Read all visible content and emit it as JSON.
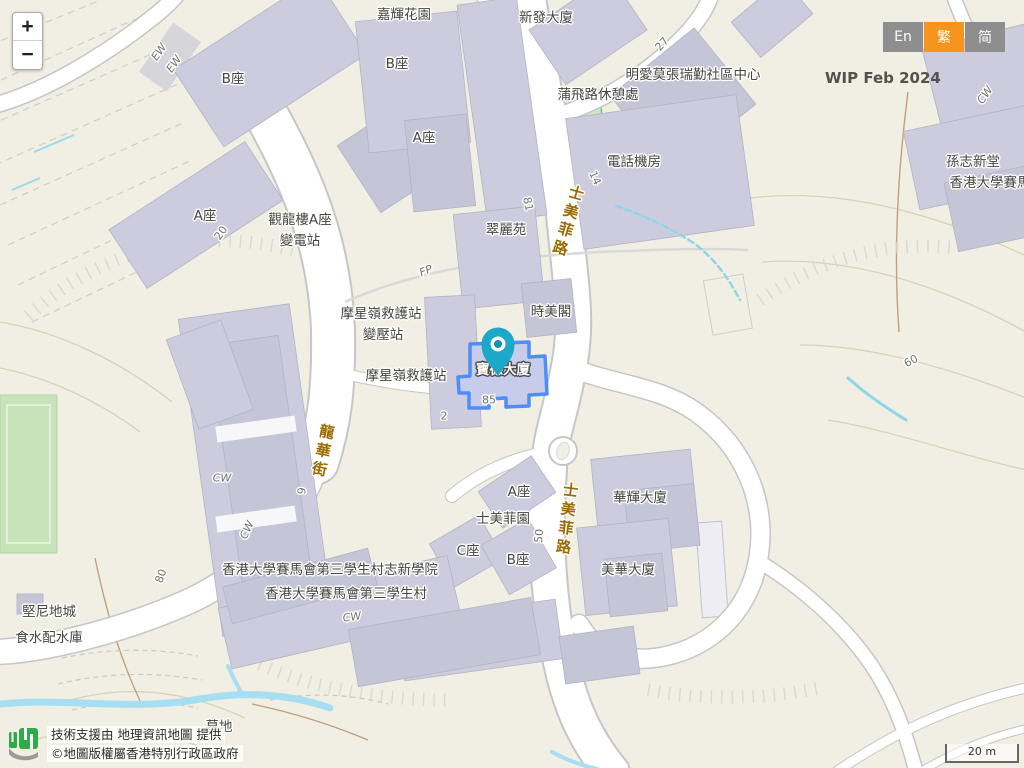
{
  "zoom_control": {
    "zoom_in": "+",
    "zoom_out": "−"
  },
  "language_switcher": {
    "options": [
      {
        "label": "En",
        "active": false
      },
      {
        "label": "繁",
        "active": true
      },
      {
        "label": "简",
        "active": false
      }
    ],
    "active_color": "#f7941d",
    "inactive_color": "#8e8e8e"
  },
  "watermark": "WIP Feb 2024",
  "attribution": {
    "line1": "技術支援由 地理資訊地圖 提供",
    "line2": "©地圖版權屬香港特別行政區政府",
    "logo": "geoinfo-map-logo"
  },
  "scale_bar": {
    "label": "20 m"
  },
  "marker": {
    "building": "寶德大廈",
    "icon": "location-pin-icon",
    "color": "#1ba8c9"
  },
  "colors": {
    "selection_outline": "#4f8ef7",
    "road_label": "#9c6a00",
    "building_fill": "#cdccdf",
    "map_background": "#f1efe3"
  },
  "map_labels": [
    {
      "kind": "bldg",
      "t": "嘉輝花園",
      "x": 404,
      "y": 13
    },
    {
      "kind": "bldg",
      "t": "新發大廈",
      "x": 546,
      "y": 16
    },
    {
      "kind": "bldg",
      "t": "B座",
      "x": 233,
      "y": 77
    },
    {
      "kind": "bldg",
      "t": "B座",
      "x": 397,
      "y": 62
    },
    {
      "kind": "bldg",
      "t": "A座",
      "x": 424,
      "y": 136
    },
    {
      "kind": "bldg",
      "t": "明愛莫張瑞勤社區中心",
      "x": 693,
      "y": 73
    },
    {
      "kind": "bldg",
      "t": "蒲飛路休憩處",
      "x": 598,
      "y": 93
    },
    {
      "kind": "bldg",
      "t": "電話機房",
      "x": 634,
      "y": 160
    },
    {
      "kind": "bldg",
      "t": "孫志新堂",
      "x": 973,
      "y": 160
    },
    {
      "kind": "bldg",
      "t": "香港大學賽馬",
      "x": 990,
      "y": 181
    },
    {
      "kind": "bldg",
      "t": "A座",
      "x": 205,
      "y": 214
    },
    {
      "kind": "bldg",
      "t": "觀龍樓A座",
      "x": 300,
      "y": 218
    },
    {
      "kind": "bldg",
      "t": "變電站",
      "x": 300,
      "y": 239
    },
    {
      "kind": "bldg",
      "t": "翠麗苑",
      "x": 506,
      "y": 228
    },
    {
      "kind": "bldg",
      "t": "時美閣",
      "x": 551,
      "y": 310
    },
    {
      "kind": "bldg",
      "t": "摩星嶺救護站",
      "x": 381,
      "y": 312
    },
    {
      "kind": "bldg",
      "t": "變壓站",
      "x": 383,
      "y": 333
    },
    {
      "kind": "bldg",
      "t": "摩星嶺救護站",
      "x": 406,
      "y": 374
    },
    {
      "kind": "sel",
      "t": "寶德大廈",
      "x": 503,
      "y": 368
    },
    {
      "kind": "bldg",
      "t": "A座",
      "x": 519,
      "y": 490
    },
    {
      "kind": "bldg",
      "t": "士美菲園",
      "x": 503,
      "y": 517
    },
    {
      "kind": "bldg",
      "t": "C座",
      "x": 468,
      "y": 549
    },
    {
      "kind": "bldg",
      "t": "B座",
      "x": 518,
      "y": 558
    },
    {
      "kind": "bldg",
      "t": "華輝大廈",
      "x": 640,
      "y": 496
    },
    {
      "kind": "bldg",
      "t": "美華大廈",
      "x": 628,
      "y": 568
    },
    {
      "kind": "bldg",
      "t": "香港大學賽馬會第三學生村志新學院",
      "x": 330,
      "y": 568
    },
    {
      "kind": "bldg",
      "t": "香港大學賽馬會第三學生村",
      "x": 346,
      "y": 592
    },
    {
      "kind": "bldg",
      "t": "堅尼地城",
      "x": 49,
      "y": 610
    },
    {
      "kind": "bldg",
      "t": "食水配水庫",
      "x": 49,
      "y": 636
    },
    {
      "kind": "bldg",
      "t": "墓地",
      "x": 219,
      "y": 725
    },
    {
      "kind": "road",
      "t": "士美菲路",
      "x": 568,
      "y": 222,
      "rot": 16
    },
    {
      "kind": "road",
      "t": "士美菲路",
      "x": 567,
      "y": 520,
      "rot": 7
    },
    {
      "kind": "road",
      "t": "龍華街",
      "x": 323,
      "y": 452,
      "rot": 11
    },
    {
      "kind": "path",
      "t": "EW",
      "x": 159,
      "y": 52,
      "rot": -55
    },
    {
      "kind": "path",
      "t": "EW",
      "x": 174,
      "y": 64,
      "rot": -55
    },
    {
      "kind": "path",
      "t": "FP",
      "x": 426,
      "y": 271,
      "rot": -22
    },
    {
      "kind": "path",
      "t": "CW",
      "x": 222,
      "y": 478,
      "rot": 0
    },
    {
      "kind": "path",
      "t": "CW",
      "x": 247,
      "y": 530,
      "rot": -65
    },
    {
      "kind": "path",
      "t": "CW",
      "x": 352,
      "y": 617,
      "rot": -8
    },
    {
      "kind": "path",
      "t": "CW",
      "x": 985,
      "y": 95,
      "rot": -55
    },
    {
      "kind": "num",
      "t": "20",
      "x": 221,
      "y": 233,
      "rot": -55
    },
    {
      "kind": "num",
      "t": "27",
      "x": 662,
      "y": 44,
      "rot": -48
    },
    {
      "kind": "num",
      "t": "81",
      "x": 528,
      "y": 204,
      "rot": 78
    },
    {
      "kind": "num",
      "t": "14",
      "x": 595,
      "y": 178,
      "rot": 65
    },
    {
      "kind": "num",
      "t": "85",
      "x": 489,
      "y": 400,
      "rot": 0
    },
    {
      "kind": "num",
      "t": "2",
      "x": 444,
      "y": 416,
      "rot": 0
    },
    {
      "kind": "num",
      "t": "9",
      "x": 302,
      "y": 491,
      "rot": -83
    },
    {
      "kind": "num",
      "t": "50",
      "x": 539,
      "y": 536,
      "rot": -85
    },
    {
      "kind": "num",
      "t": "80",
      "x": 161,
      "y": 576,
      "rot": -70
    },
    {
      "kind": "num",
      "t": "60",
      "x": 911,
      "y": 361,
      "rot": -28
    }
  ]
}
